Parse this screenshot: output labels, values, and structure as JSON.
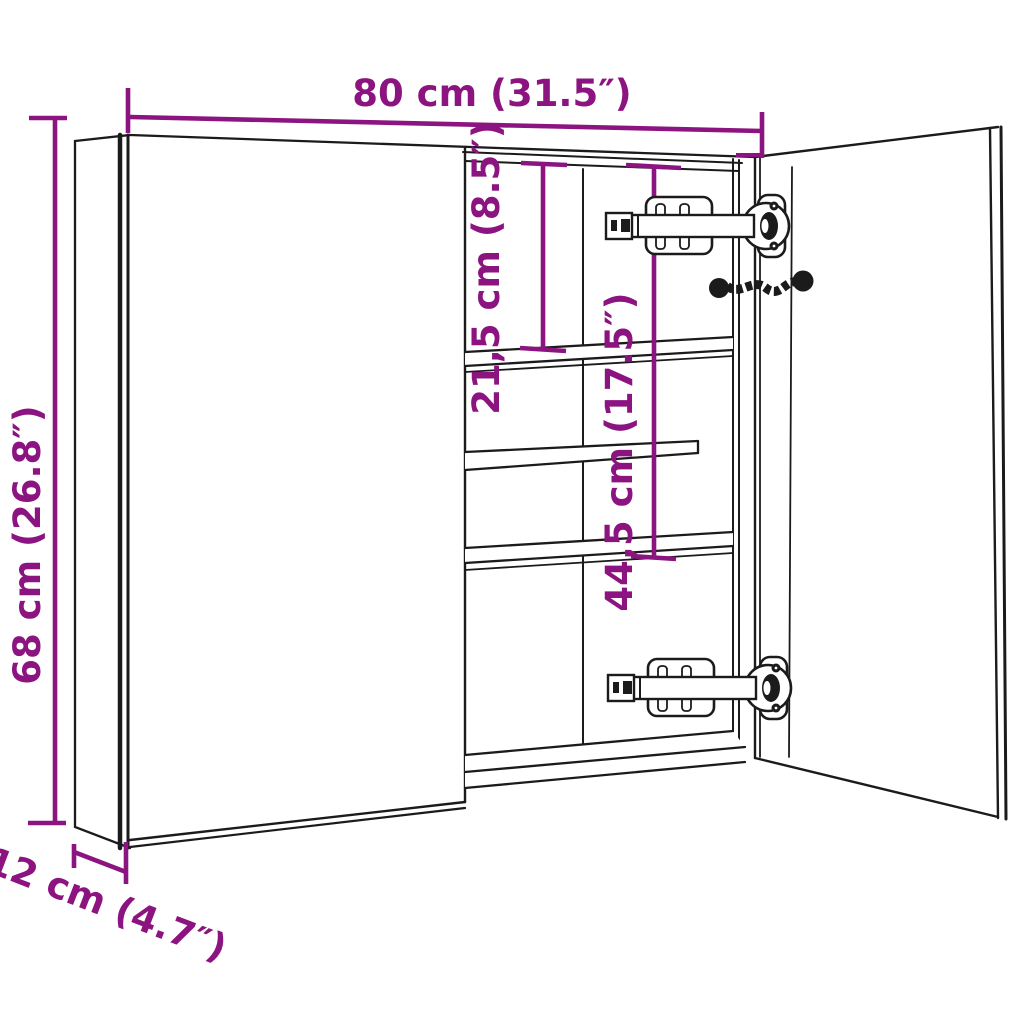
{
  "diagram": {
    "type": "furniture-dimension-drawing",
    "subject": "Bathroom mirror cabinet, two doors, right door open showing shelves, hinges and cord",
    "colors": {
      "dimension": "#8C1480",
      "outline": "#1b1b1b",
      "background": "#ffffff"
    },
    "dimensions": {
      "width": "80 cm (31.5″)",
      "height": "68 cm (26.8″)",
      "depth": "12 cm (4.7″)",
      "upper_shelf_spacing": "21,5 cm (8.5″)",
      "middle_section_height": "44,5 cm (17.5″)"
    }
  }
}
